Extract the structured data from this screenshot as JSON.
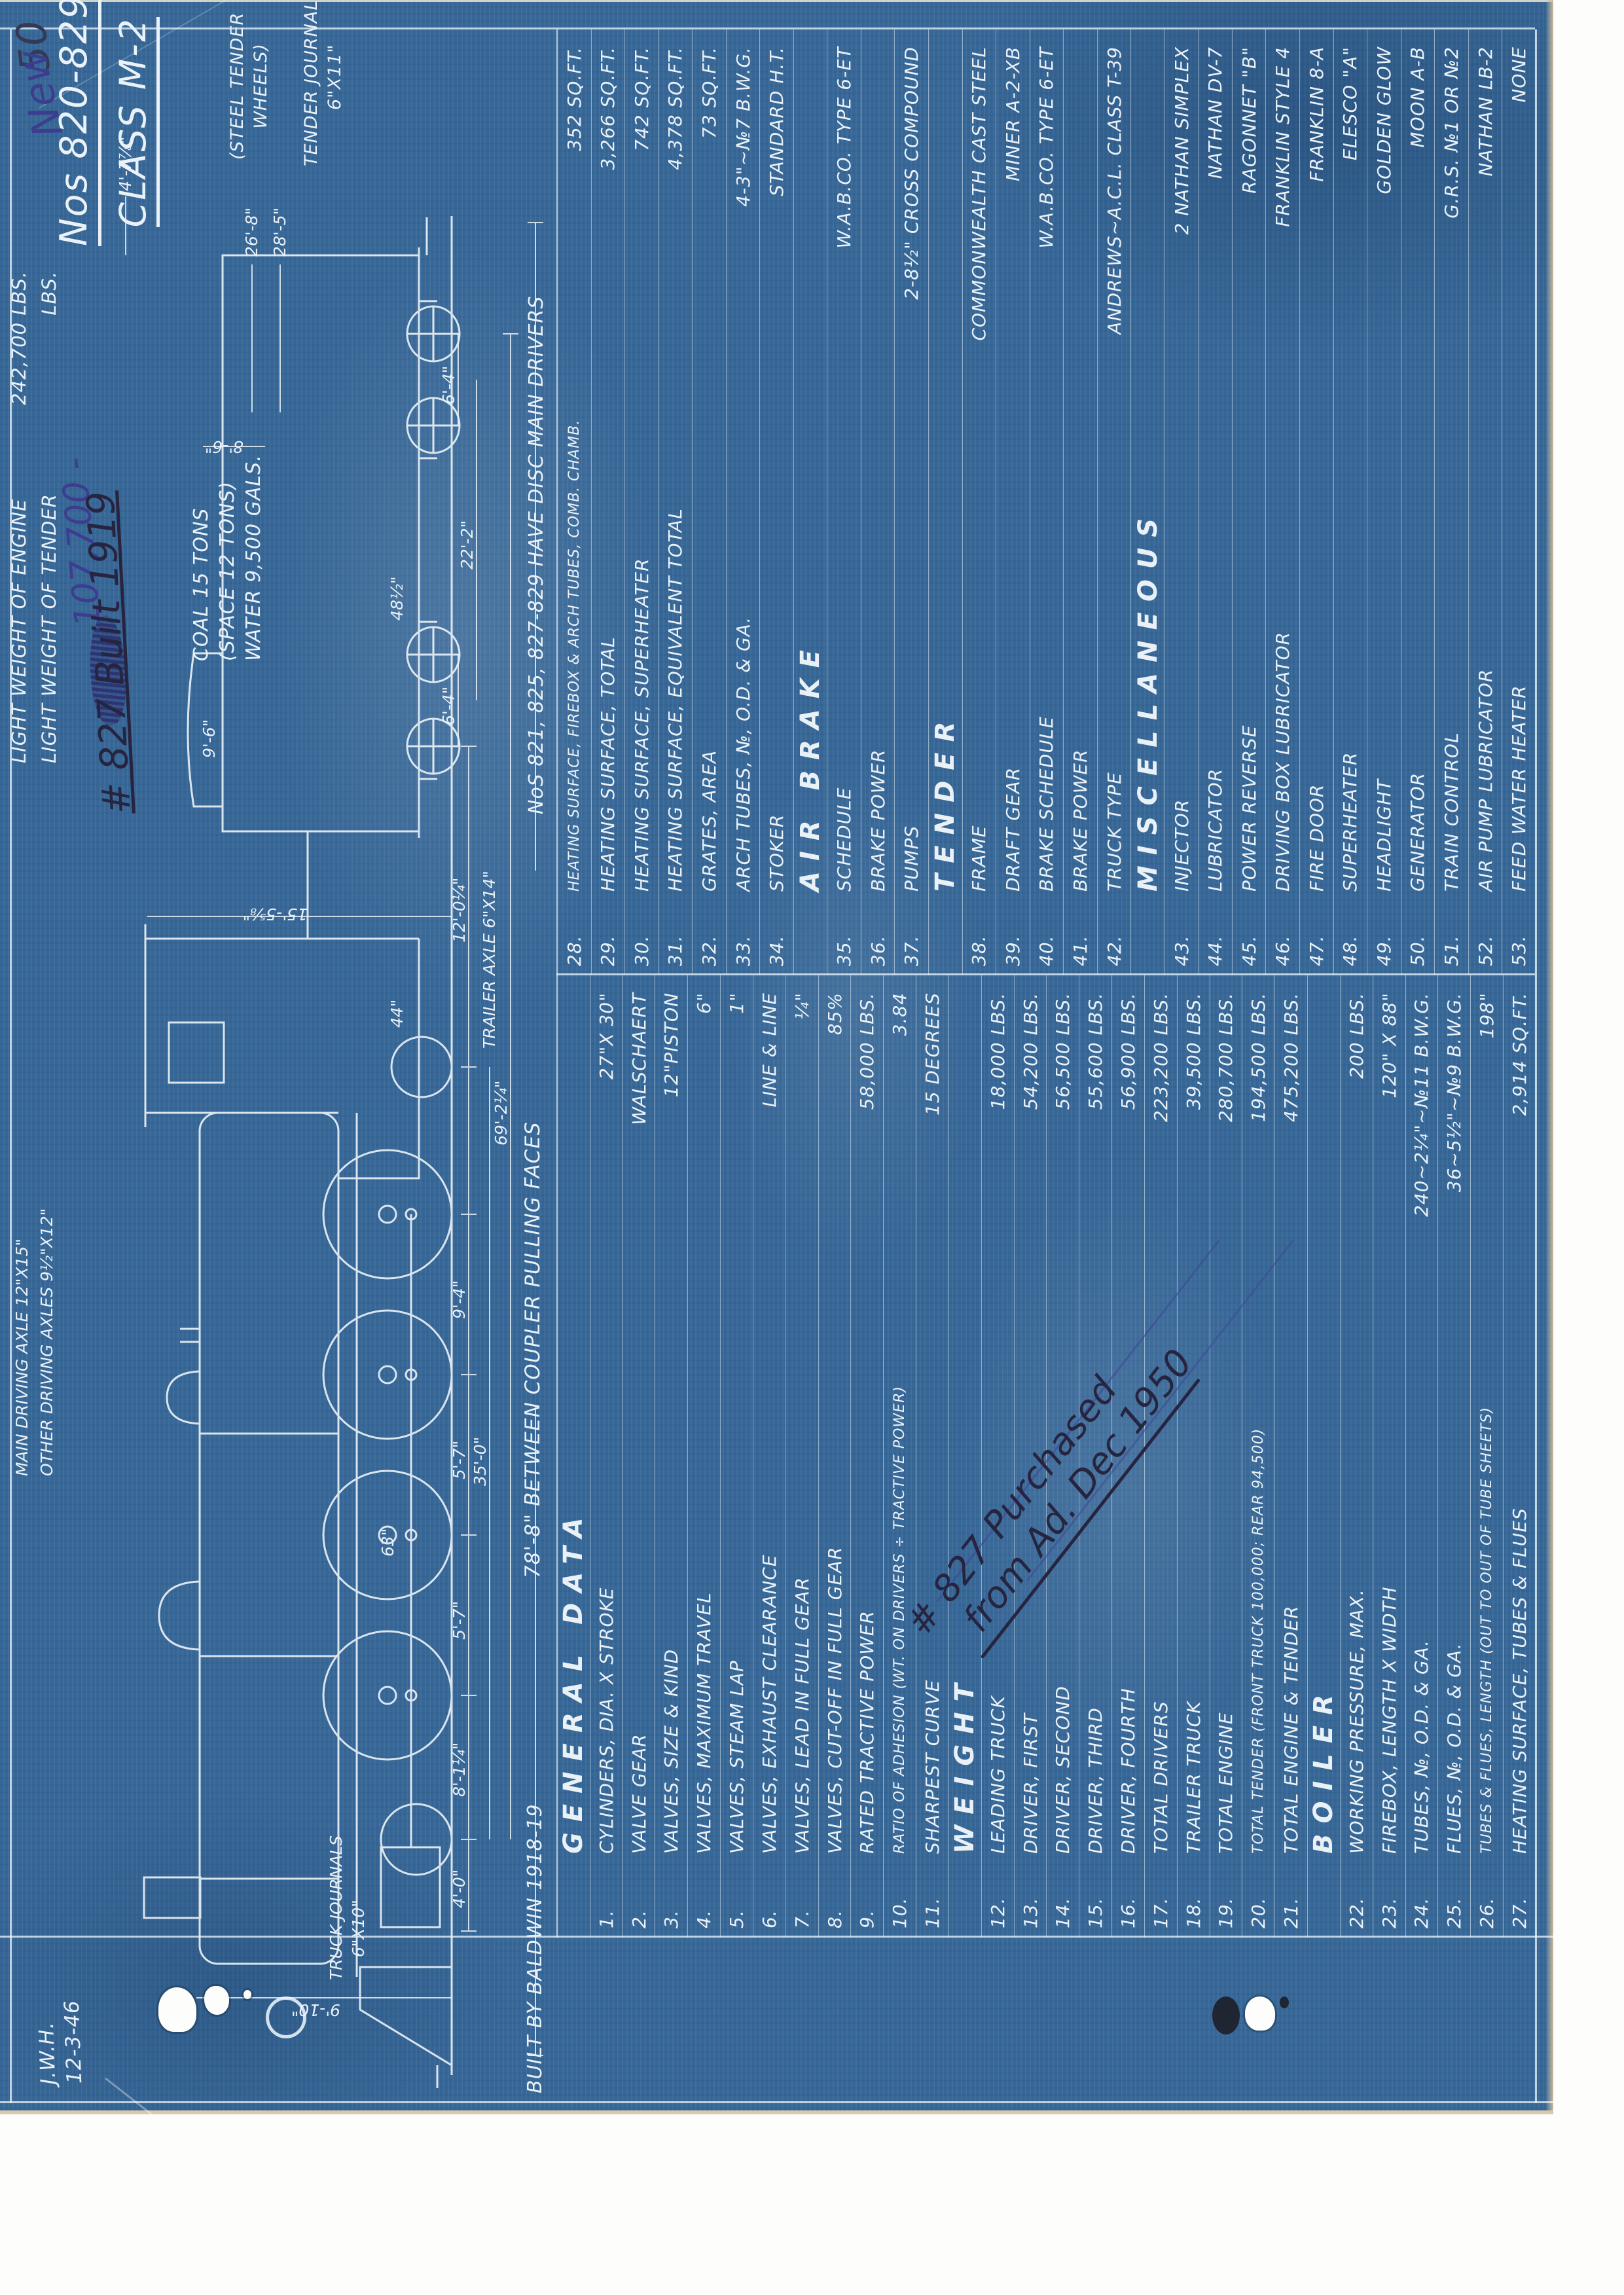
{
  "title": {
    "sheet_number": "50",
    "road_numbers": "Nos 820-829",
    "class_name": "CLASS M-2"
  },
  "corner": {
    "initials": "J.W.H.",
    "date": "12-3-46"
  },
  "weights": {
    "engine_label": "LIGHT WEIGHT OF ENGINE",
    "engine_value": "242,700 LBS.",
    "tender_label": "LIGHT WEIGHT OF TENDER",
    "tender_units": "LBS."
  },
  "annotations": {
    "new_weight": "107,700 -",
    "new_word": "New",
    "built": "# 827 Built 1919",
    "purchased_line1": "# 827 Purchased",
    "purchased_line2": "from Ad. Dec 1950"
  },
  "meta": {
    "builder": "BUILT BY BALDWIN 1918-19",
    "coupler": "78'-8\" BETWEEN COUPLER PULLING FACES",
    "disc_note": "NoS 821, 825, 827-829 HAVE DISC MAIN DRIVERS"
  },
  "tender_notes": {
    "wheels_1": "(STEEL TENDER",
    "wheels_2": "WHEELS)",
    "journals_1": "TENDER JOURNALS",
    "journals_2": "6\"X11\""
  },
  "drawing": {
    "coal_1": "COAL 15 TONS",
    "coal_2": "(SPACE 12 TONS)",
    "coal_3": "WATER 9,500 GALS.",
    "axle_main": "MAIN DRIVING AXLE 12\"X15\"",
    "axle_other": "OTHER DRIVING AXLES 9½\"X12\"",
    "trailer_axle": "TRAILER AXLE 6\"X14\"",
    "truck_journals_1": "TRUCK JOURNALS",
    "truck_journals_2": "6\"X10\"",
    "wheel_63": "63\"",
    "wheel_44": "44\"",
    "wheel_48": "48½\"",
    "dims": {
      "d4_0": "4'-0\"",
      "d8_1": "8'-1¼\"",
      "d5_7a": "5'-7\"",
      "d5_7b": "5'-7\"",
      "d9_4": "9'-4\"",
      "d35_0": "35'-0\"",
      "d69_2": "69'-2¼\"",
      "d12_0": "12'-0¼\"",
      "d6_4a": "6'-4\"",
      "d6_4b": "6'-4\"",
      "d22_2": "22'-2\"",
      "d26_8": "26'-8\"",
      "d28_5": "28'-5\"",
      "d8_6": "8'-6\"",
      "d9_6": "9'-6\"",
      "d4_7": "4'-7⅞\"",
      "d15_5": "15'-5⅝\"",
      "d9_10": "9'-10\""
    }
  },
  "table": {
    "left": [
      {
        "type": "header",
        "label": "GENERAL DATA"
      },
      {
        "num": "1.",
        "label": "CYLINDERS, DIA. X STROKE",
        "value": "27\"X 30\""
      },
      {
        "num": "2.",
        "label": "VALVE GEAR",
        "value": "WALSCHAERT"
      },
      {
        "num": "3.",
        "label": "VALVES, SIZE & KIND",
        "value": "12\"PISTON"
      },
      {
        "num": "4.",
        "label": "VALVES, MAXIMUM TRAVEL",
        "value": "6\""
      },
      {
        "num": "5.",
        "label": "VALVES, STEAM LAP",
        "value": "1\""
      },
      {
        "num": "6.",
        "label": "VALVES, EXHAUST CLEARANCE",
        "value": "LINE & LINE"
      },
      {
        "num": "7.",
        "label": "VALVES, LEAD IN FULL GEAR",
        "value": "¼\""
      },
      {
        "num": "8.",
        "label": "VALVES, CUT-OFF IN FULL GEAR",
        "value": "85%"
      },
      {
        "num": "9.",
        "label": "RATED TRACTIVE POWER",
        "value": "58,000 LBS."
      },
      {
        "num": "10.",
        "label": "RATIO OF ADHESION (WT. ON DRIVERS ÷ TRACTIVE POWER)",
        "value": "3.84"
      },
      {
        "num": "11.",
        "label": "SHARPEST CURVE",
        "value": "15 DEGREES"
      },
      {
        "type": "header",
        "label": "WEIGHT"
      },
      {
        "num": "12.",
        "label": "LEADING TRUCK",
        "value": "18,000 LBS."
      },
      {
        "num": "13.",
        "label": "DRIVER, FIRST",
        "value": "54,200 LBS."
      },
      {
        "num": "14.",
        "label": "DRIVER, SECOND",
        "value": "56,500 LBS."
      },
      {
        "num": "15.",
        "label": "DRIVER, THIRD",
        "value": "55,600 LBS."
      },
      {
        "num": "16.",
        "label": "DRIVER, FOURTH",
        "value": "56,900 LBS."
      },
      {
        "num": "17.",
        "label": "TOTAL DRIVERS",
        "value": "223,200 LBS."
      },
      {
        "num": "18.",
        "label": "TRAILER TRUCK",
        "value": "39,500 LBS."
      },
      {
        "num": "19.",
        "label": "TOTAL ENGINE",
        "value": "280,700 LBS."
      },
      {
        "num": "20.",
        "label": "TOTAL TENDER (FRONT TRUCK 100,000; REAR 94,500)",
        "value": "194,500 LBS."
      },
      {
        "num": "21.",
        "label": "TOTAL ENGINE & TENDER",
        "value": "475,200 LBS."
      },
      {
        "type": "header",
        "label": "BOILER"
      },
      {
        "num": "22.",
        "label": "WORKING PRESSURE, MAX.",
        "value": "200 LBS."
      },
      {
        "num": "23.",
        "label": "FIREBOX, LENGTH X WIDTH",
        "value": "120\" X 88\""
      },
      {
        "num": "24.",
        "label": "TUBES, №, O.D. & GA.",
        "value": "240~2¼\"~№11 B.W.G."
      },
      {
        "num": "25.",
        "label": "FLUES, №, O.D. & GA.",
        "value": "36~5½\"~№9 B.W.G."
      },
      {
        "num": "26.",
        "label": "TUBES & FLUES, LENGTH (OUT TO OUT OF TUBE SHEETS)",
        "value": "198\""
      },
      {
        "num": "27.",
        "label": "HEATING SURFACE, TUBES & FLUES",
        "value": "2,914 SQ.FT."
      }
    ],
    "right": [
      {
        "num": "28.",
        "label": "HEATING SURFACE, FIREBOX & ARCH TUBES, COMB. CHAMB.",
        "value": "352 SQ.FT."
      },
      {
        "num": "29.",
        "label": "HEATING SURFACE, TOTAL",
        "value": "3,266 SQ.FT."
      },
      {
        "num": "30.",
        "label": "HEATING SURFACE, SUPERHEATER",
        "value": "742 SQ.FT."
      },
      {
        "num": "31.",
        "label": "HEATING SURFACE, EQUIVALENT TOTAL",
        "value": "4,378 SQ.FT."
      },
      {
        "num": "32.",
        "label": "GRATES, AREA",
        "value": "73 SQ.FT."
      },
      {
        "num": "33.",
        "label": "ARCH TUBES, №, O.D. & GA.",
        "value": "4-3\"~№7 B.W.G."
      },
      {
        "num": "34.",
        "label": "STOKER",
        "value": "STANDARD H.T."
      },
      {
        "type": "header",
        "label": "AIR BRAKE"
      },
      {
        "num": "35.",
        "label": "SCHEDULE",
        "value": "W.A.B.CO. TYPE 6-ET"
      },
      {
        "num": "36.",
        "label": "BRAKE POWER",
        "value": ""
      },
      {
        "num": "37.",
        "label": "PUMPS",
        "value": "2-8½\" CROSS COMPOUND"
      },
      {
        "type": "header",
        "label": "TENDER"
      },
      {
        "num": "38.",
        "label": "FRAME",
        "value": "COMMONWEALTH CAST STEEL"
      },
      {
        "num": "39.",
        "label": "DRAFT GEAR",
        "value": "MINER A-2-XB"
      },
      {
        "num": "40.",
        "label": "BRAKE SCHEDULE",
        "value": "W.A.B.CO. TYPE 6-ET"
      },
      {
        "num": "41.",
        "label": "BRAKE POWER",
        "value": ""
      },
      {
        "num": "42.",
        "label": "TRUCK TYPE",
        "value": "ANDREWS~A.C.L. CLASS T-39"
      },
      {
        "type": "header",
        "label": "MISCELLANEOUS"
      },
      {
        "num": "43.",
        "label": "INJECTOR",
        "value": "2 NATHAN SIMPLEX"
      },
      {
        "num": "44.",
        "label": "LUBRICATOR",
        "value": "NATHAN DV-7"
      },
      {
        "num": "45.",
        "label": "POWER REVERSE",
        "value": "RAGONNET \"B\""
      },
      {
        "num": "46.",
        "label": "DRIVING BOX LUBRICATOR",
        "value": "FRANKLIN STYLE 4"
      },
      {
        "num": "47.",
        "label": "FIRE DOOR",
        "value": "FRANKLIN 8-A"
      },
      {
        "num": "48.",
        "label": "SUPERHEATER",
        "value": "ELESCO \"A\""
      },
      {
        "num": "49.",
        "label": "HEADLIGHT",
        "value": "GOLDEN GLOW"
      },
      {
        "num": "50.",
        "label": "GENERATOR",
        "value": "MOON A-B"
      },
      {
        "num": "51.",
        "label": "TRAIN CONTROL",
        "value": "G.R.S. №1 OR №2"
      },
      {
        "num": "52.",
        "label": "AIR PUMP LUBRICATOR",
        "value": "NATHAN LB-2"
      },
      {
        "num": "53.",
        "label": "FEED WATER HEATER",
        "value": "NONE"
      }
    ]
  },
  "colors": {
    "card_blue": "#376797",
    "lettering": "#e9f1f7",
    "paper": "#fdfdfc",
    "edge_tan": "#d8c9ae",
    "ink_black": "#272440",
    "ink_blue": "#3d3d8f"
  }
}
